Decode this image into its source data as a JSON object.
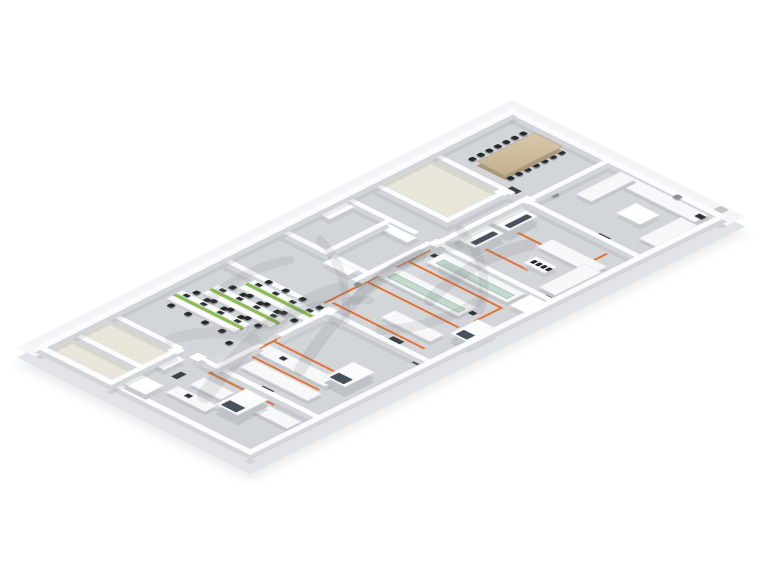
{
  "page": {
    "background": "#ffffff"
  },
  "scene": {
    "type": "isometric-floor-plan",
    "plan_size": [
      330,
      700
    ],
    "palette": {
      "slab": "#f5f6f7",
      "slab_side": "#e2e5e7",
      "floor": "#d3d6d9",
      "floor_beige": "#e9e6db",
      "corridor": "#d8dbde",
      "wall": "#fcfdfe",
      "bench": "#f7f8f9",
      "glass_shelf": "#bfd7c8",
      "green_partition": "#8cbd52",
      "wood_table": "#cdbb9c",
      "chair": "#26292c",
      "orange_line": "#e46f30",
      "mat": "#2d3136",
      "hood_window": "#48525c"
    },
    "floors": [
      {
        "r": [
          21,
          21,
          288,
          658
        ],
        "c": "#d3d6d9"
      },
      {
        "r": [
          153,
          134,
          30,
          448
        ],
        "c": "#d8dbde"
      },
      {
        "r": [
          21,
          134,
          100,
          78
        ],
        "c": "#e9e6db"
      },
      {
        "r": [
          21,
          591,
          92,
          88
        ],
        "c": "#e9e6db"
      }
    ],
    "walls": [
      [
        13,
        13,
        304,
        8
      ],
      [
        13,
        13,
        8,
        674
      ],
      [
        309,
        13,
        8,
        674
      ],
      [
        13,
        679,
        304,
        8
      ],
      [
        150,
        21,
        7,
        107
      ],
      [
        21,
        128,
        112,
        7
      ],
      [
        156,
        128,
        153,
        7
      ],
      [
        121,
        134,
        7,
        78
      ],
      [
        21,
        212,
        107,
        7
      ],
      [
        146,
        134,
        7,
        118
      ],
      [
        21,
        252,
        100,
        7
      ],
      [
        148,
        252,
        161,
        7
      ],
      [
        140,
        259,
        7,
        108
      ],
      [
        80,
        259,
        7,
        84
      ],
      [
        21,
        343,
        120,
        7
      ],
      [
        21,
        425,
        112,
        7
      ],
      [
        172,
        425,
        137,
        7
      ],
      [
        165,
        432,
        7,
        66
      ],
      [
        165,
        523,
        7,
        59
      ],
      [
        21,
        582,
        96,
        7
      ],
      [
        140,
        582,
        169,
        7
      ],
      [
        113,
        589,
        7,
        98
      ],
      [
        21,
        636,
        94,
        7
      ]
    ],
    "cols": [
      [
        146,
        124,
        13,
        13
      ],
      [
        143,
        249,
        13,
        13
      ],
      [
        162,
        421,
        13,
        13
      ],
      [
        135,
        579,
        13,
        13
      ],
      [
        117,
        130,
        13,
        13
      ],
      [
        110,
        585,
        13,
        13
      ]
    ],
    "olines": [
      [
        157,
        140,
        3,
        106
      ],
      [
        160,
        182,
        68,
        3
      ],
      [
        160,
        228,
        92,
        3
      ],
      [
        283,
        150,
        3,
        96
      ],
      [
        153,
        262,
        3,
        158
      ],
      [
        156,
        300,
        132,
        3
      ],
      [
        156,
        358,
        128,
        3
      ],
      [
        285,
        302,
        3,
        38
      ],
      [
        160,
        412,
        130,
        3
      ],
      [
        171,
        436,
        3,
        134
      ],
      [
        174,
        508,
        108,
        3
      ],
      [
        174,
        545,
        100,
        3
      ],
      [
        171,
        574,
        3,
        28
      ],
      [
        171,
        598,
        92,
        3
      ]
    ],
    "mats": [
      [
        122,
        122,
        14,
        8
      ],
      [
        250,
        126,
        16,
        8
      ],
      [
        192,
        252,
        16,
        8
      ],
      [
        142,
        308,
        8,
        14
      ],
      [
        250,
        418,
        16,
        8
      ],
      [
        168,
        468,
        8,
        14
      ],
      [
        228,
        580,
        16,
        8
      ],
      [
        150,
        618,
        8,
        14
      ],
      [
        300,
        238,
        8,
        14
      ],
      [
        300,
        428,
        8,
        14
      ]
    ],
    "furniture": [
      {
        "t": "table",
        "r": [
          62,
          30,
          40,
          82
        ]
      },
      {
        "t": "bench",
        "r": [
          178,
          24,
          124,
          20
        ]
      },
      {
        "t": "bench",
        "r": [
          178,
          24,
          22,
          64
        ]
      },
      {
        "t": "bench",
        "r": [
          285,
          46,
          24,
          60
        ]
      },
      {
        "t": "cab",
        "r": [
          233,
          58,
          34,
          28
        ]
      },
      {
        "t": "monitor",
        "r": [
          293,
          28,
          10,
          7
        ]
      },
      {
        "t": "fixture",
        "r": [
          160,
          100,
          8,
          8
        ]
      },
      {
        "t": "fixture",
        "r": [
          250,
          16,
          8,
          8
        ]
      },
      {
        "t": "dot",
        "r": [
          297,
          2,
          12,
          10
        ]
      },
      {
        "t": "hood",
        "r": [
          153,
          146,
          30,
          42
        ],
        "s": "r"
      },
      {
        "t": "hood",
        "r": [
          153,
          194,
          30,
          42
        ],
        "s": "r"
      },
      {
        "t": "bench",
        "r": [
          225,
          168,
          78,
          22
        ]
      },
      {
        "t": "rack",
        "r": [
          238,
          204,
          30,
          18
        ]
      },
      {
        "t": "bench",
        "r": [
          283,
          180,
          24,
          66
        ]
      },
      {
        "t": "glassbench",
        "r": [
          168,
          264,
          115,
          26
        ]
      },
      {
        "t": "glassbench",
        "r": [
          153,
          318,
          115,
          26
        ]
      },
      {
        "t": "hood",
        "r": [
          286,
          334,
          26,
          40
        ],
        "s": "b"
      },
      {
        "t": "cab",
        "r": [
          288,
          262,
          22,
          30
        ]
      },
      {
        "t": "cab",
        "r": [
          26,
          262,
          14,
          36
        ]
      },
      {
        "t": "cab",
        "r": [
          88,
          262,
          40,
          14
        ]
      },
      {
        "t": "cab",
        "r": [
          96,
          350,
          36,
          14
        ]
      },
      {
        "t": "bench",
        "r": [
          214,
          380,
          70,
          20
        ]
      },
      {
        "t": "monitor",
        "r": [
          162,
          272,
          7,
          6
        ]
      },
      {
        "t": "monitor",
        "r": [
          270,
          326,
          7,
          6
        ]
      },
      {
        "t": "fixture",
        "r": [
          148,
          290,
          7,
          7
        ]
      },
      {
        "t": "fixture",
        "r": [
          148,
          366,
          7,
          7
        ]
      },
      {
        "t": "bench",
        "r": [
          175,
          518,
          100,
          20
        ]
      },
      {
        "t": "bench",
        "r": [
          185,
          550,
          96,
          20
        ]
      },
      {
        "t": "hood",
        "r": [
          258,
          482,
          30,
          42
        ],
        "s": "b"
      },
      {
        "t": "monitor",
        "r": [
          200,
          524,
          7,
          6
        ]
      },
      {
        "t": "fixture",
        "r": [
          168,
          455,
          7,
          7
        ]
      },
      {
        "t": "chair",
        "r": [
          140,
          540,
          7,
          7
        ]
      },
      {
        "t": "hood",
        "r": [
          220,
          596,
          32,
          44
        ],
        "s": "b"
      },
      {
        "t": "bench",
        "r": [
          174,
          610,
          44,
          20
        ]
      },
      {
        "t": "bench",
        "r": [
          256,
          604,
          50,
          20
        ]
      },
      {
        "t": "bench",
        "r": [
          168,
          640,
          56,
          18
        ]
      },
      {
        "t": "monitor",
        "r": [
          186,
          644,
          7,
          6
        ]
      },
      {
        "t": "cab",
        "r": [
          126,
          650,
          32,
          26
        ]
      },
      {
        "t": "cab",
        "r": [
          118,
          598,
          18,
          30
        ]
      }
    ],
    "chair_rows": [
      {
        "p": [
          52,
          36
        ],
        "d": [
          0,
          12
        ],
        "n": 7
      },
      {
        "p": [
          106,
          36
        ],
        "d": [
          0,
          12
        ],
        "n": 7
      }
    ],
    "desk_rows": [
      {
        "p": [
          72,
          436
        ],
        "w": 96
      },
      {
        "p": [
          54,
          469
        ],
        "w": 96
      },
      {
        "p": [
          36,
          502
        ],
        "w": 96
      }
    ],
    "watermark": {
      "color": "#676c70",
      "strokes": [
        {
          "d": "M205,395 C255,330 300,300 340,290",
          "w": 16,
          "o": 0.13
        },
        {
          "d": "M300,370 C330,320 370,280 420,255",
          "w": 12,
          "o": 0.15
        },
        {
          "d": "M355,300 C380,270 420,250 460,245",
          "w": 10,
          "o": 0.13
        },
        {
          "d": "M250,330 C290,310 330,300 370,300",
          "w": 8,
          "o": 0.12
        },
        {
          "d": "M430,300 C460,270 500,250 530,245",
          "w": 12,
          "o": 0.14
        },
        {
          "d": "M460,230 C480,250 490,280 480,310",
          "w": 9,
          "o": 0.13
        },
        {
          "d": "M320,240 C340,260 350,290 345,320",
          "w": 9,
          "o": 0.12
        },
        {
          "d": "M380,330 C410,330 450,320 480,300",
          "w": 10,
          "o": 0.12
        },
        {
          "d": "M445,270 l30,18",
          "w": 14,
          "o": 0.12
        },
        {
          "d": "M210,300 C230,280 260,265 290,260",
          "w": 9,
          "o": 0.12
        },
        {
          "d": "M170,340 C200,330 230,330 255,340",
          "w": 11,
          "o": 0.1
        }
      ]
    }
  }
}
